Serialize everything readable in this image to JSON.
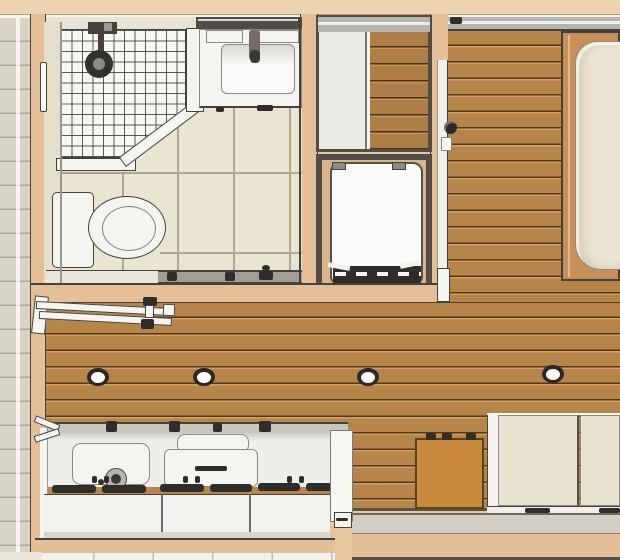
{
  "scene": {
    "type": "3d-floorplan-top-view",
    "rooms": [
      {
        "name": "bathroom",
        "fixtures": [
          "entry-door",
          "door-handle",
          "shower-tray",
          "shower-head",
          "shower-curb",
          "vanity-counter",
          "sink-basin",
          "faucet",
          "mirror-strip",
          "toilet-tank",
          "toilet-bowl",
          "sliding-door-track"
        ]
      },
      {
        "name": "closet",
        "fixtures": [
          "sliding-white-panel",
          "wood-floor"
        ]
      },
      {
        "name": "laundry-nook",
        "fixtures": [
          "washing-machine"
        ]
      },
      {
        "name": "hallway",
        "fixtures": [
          "wood-floor",
          "sliding-door-edge",
          "door-knob",
          "top-rail-track"
        ]
      },
      {
        "name": "sleeping-area",
        "fixtures": [
          "bed-frame",
          "mattress"
        ]
      },
      {
        "name": "living-kitchen",
        "fixtures": [
          "drying-rail",
          "kitchen-counter",
          "sink-lid",
          "faucet-knob",
          "countertop-appliance",
          "drawer-slots",
          "cabinet-doors",
          "side-table",
          "storage-cabinet"
        ]
      }
    ],
    "ceiling_lights": [
      {
        "x": 98,
        "y": 377
      },
      {
        "x": 204,
        "y": 377
      },
      {
        "x": 368,
        "y": 377
      },
      {
        "x": 553,
        "y": 374
      }
    ],
    "palette": {
      "wall_tan": "#e7c59d",
      "wall_tan_light": "#eed3b1",
      "siding": "#d8d4c6",
      "stud_tan": "#e4bf97",
      "wood_floor": "#b5854a",
      "closet_wood": "#ae7e46",
      "table_wood": "#c8893c",
      "bed_frame_wood": "#c7905a",
      "mattress_cream": "#ebe4d0",
      "cabinet_cream": "#e8e2d0",
      "fixture_white": "#f4f4f1",
      "tile_floor_beige": "#e9e5d0",
      "grout_gray": "#aaa795",
      "shower_tile_white": "#f7f7f4",
      "track_gray": "#b5b5af",
      "frame_dark": "#514c45",
      "outline_dark": "#44423d",
      "concrete_gray": "#d3cec3",
      "floor_white": "#f2f1ea",
      "appliance_dark": "#2f2d29"
    }
  }
}
